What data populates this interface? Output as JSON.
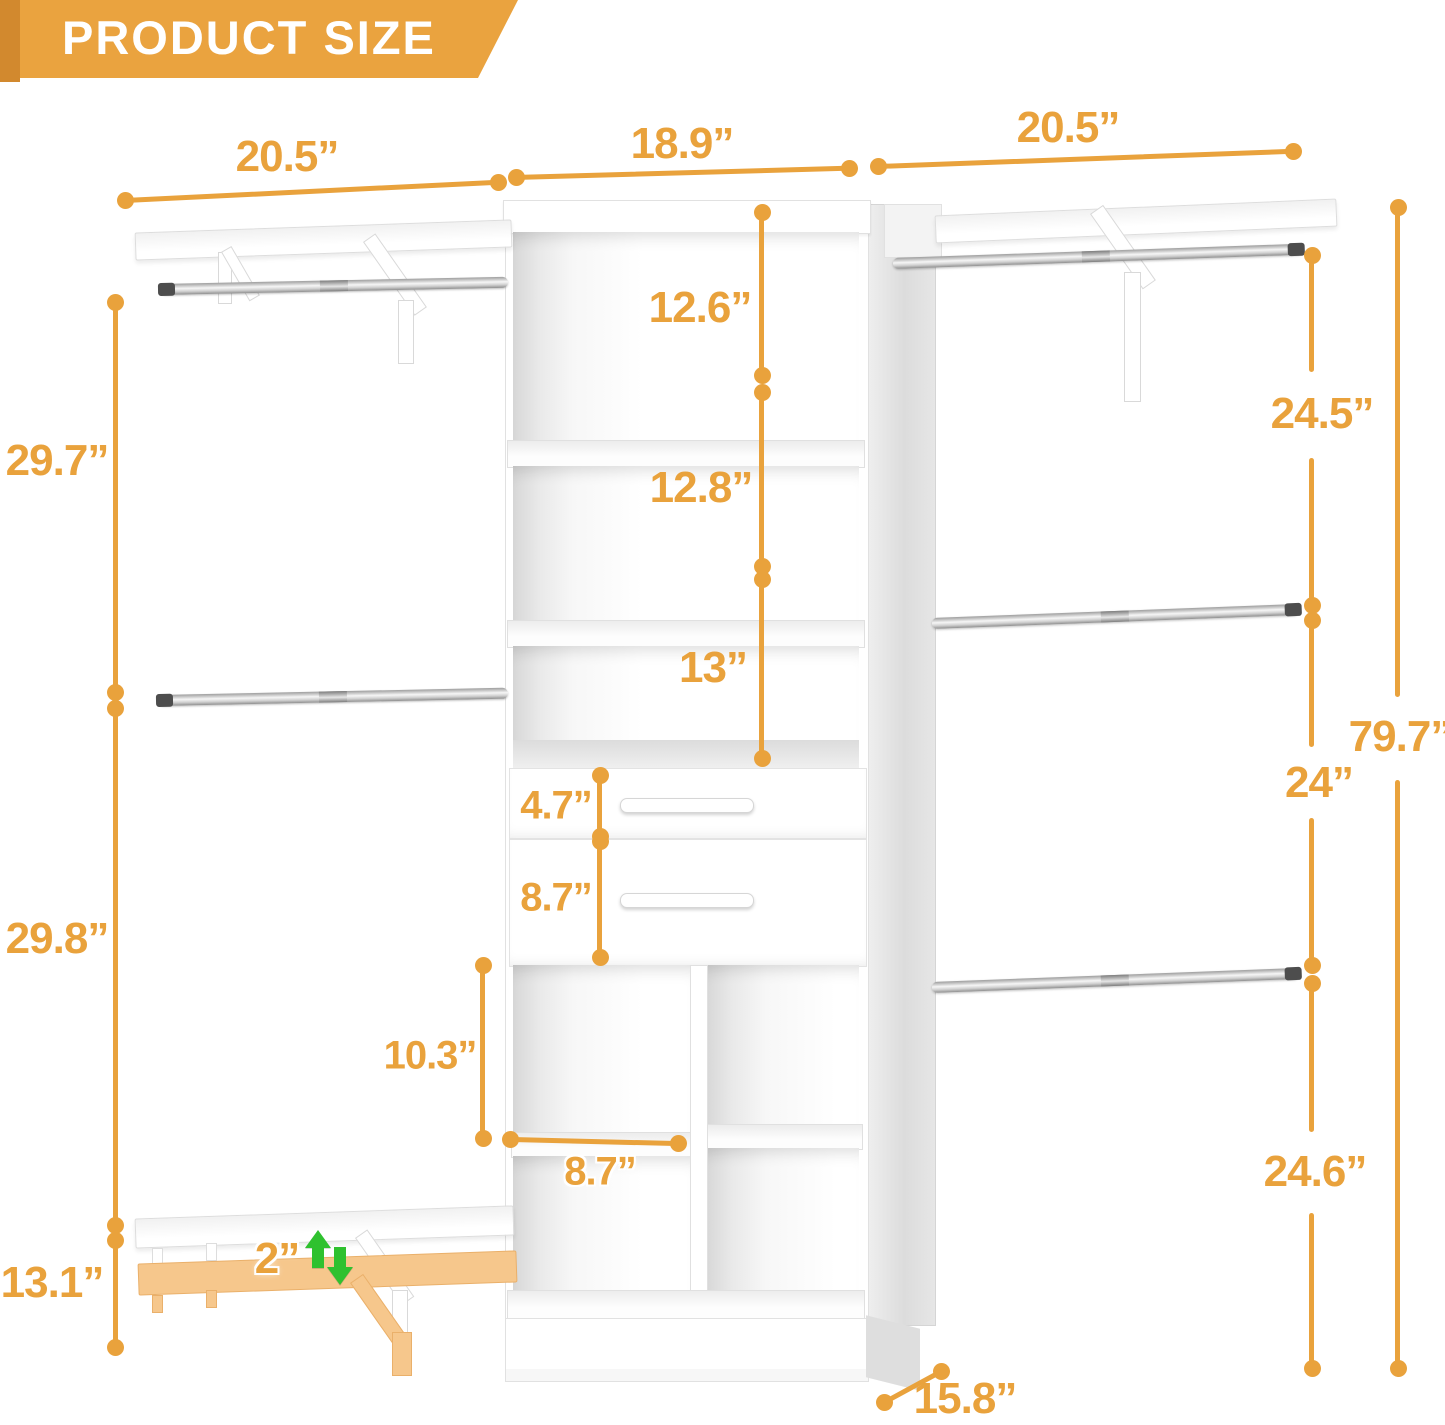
{
  "header": {
    "title": "PRODUCT SIZE"
  },
  "palette": {
    "accent": "#E9A23C",
    "accent_deep": "#D2892E",
    "ghost": "#F6C78C",
    "green": "#2FC12F",
    "banner": "#EAA33F"
  },
  "dimensions": {
    "top": {
      "left_section_width": "20.5”",
      "center_section_width": "18.9”",
      "right_section_width": "20.5”"
    },
    "left_side": {
      "upper_height": "29.7”",
      "middle_height": "29.8”",
      "lower_height": "13.1”"
    },
    "center_tower": {
      "opening_1_height": "12.6”",
      "opening_2_height": "12.8”",
      "opening_3_height": "13”",
      "drawer_1_height": "4.7”",
      "drawer_2_height": "8.7”",
      "cubby_height": "10.3”",
      "cubby_width": "8.7”"
    },
    "right_side": {
      "upper_height": "24.5”",
      "middle_height": "24”",
      "lower_height": "24.6”",
      "total_height": "79.7”"
    },
    "bottom": {
      "shelf_adjustability": "2”",
      "depth": "15.8”"
    }
  }
}
